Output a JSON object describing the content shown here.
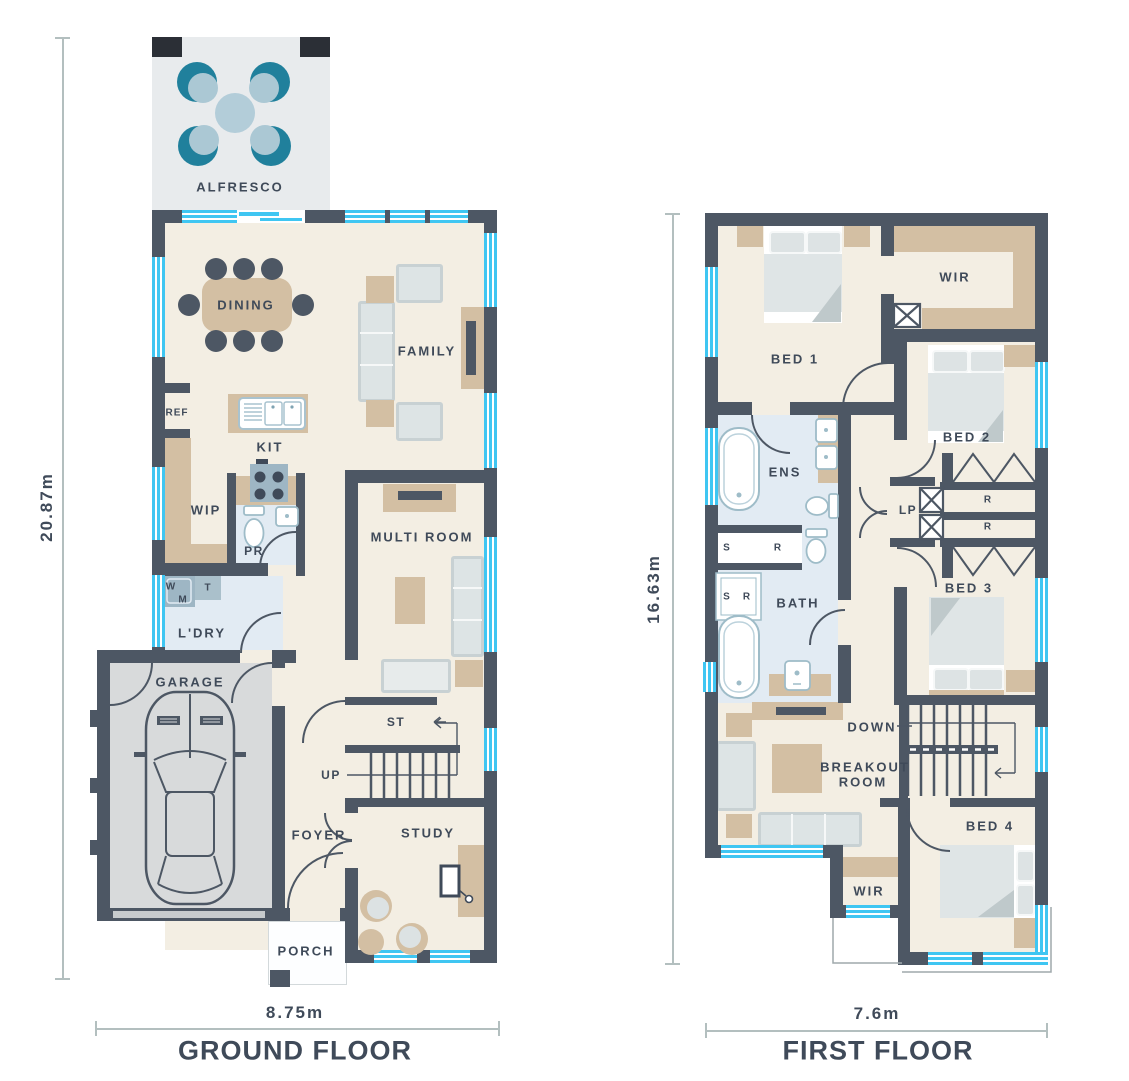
{
  "document": {
    "type": "architectural floor plan, two storeys"
  },
  "palette": {
    "wall": "#4d5764",
    "window": "#3fc6f2",
    "floor": "#f3eee3",
    "wet_area": "#e2ebf3",
    "furniture_tan": "#d3bfa3",
    "garage_floor": "#d8dadb",
    "alfresco_floor": "#e8ebed",
    "sofa_gray": "#dde4e5",
    "outdoor_teal": "#20809c",
    "outdoor_blue": "#b3cdd9",
    "text": "#3f4a59",
    "dim_line": "#b3bfbf"
  },
  "ground_floor": {
    "title": "GROUND FLOOR",
    "width_dim": "8.75m",
    "height_dim": "20.87m",
    "labels": {
      "alfresco": "ALFRESCO",
      "dining": "DINING",
      "family": "FAMILY",
      "ref": "REF",
      "kit": "KIT",
      "wip": "WIP",
      "pr": "PR",
      "multi_room": "MULTI ROOM",
      "w": "W",
      "m": "M",
      "t": "T",
      "ldry": "L'DRY",
      "garage": "GARAGE",
      "st": "ST",
      "up": "UP",
      "foyer": "FOYER",
      "study": "STUDY",
      "porch": "PORCH"
    }
  },
  "first_floor": {
    "title": "FIRST FLOOR",
    "width_dim": "7.6m",
    "height_dim": "16.63m",
    "labels": {
      "bed1": "BED 1",
      "wir": "WIR",
      "bed2": "BED 2",
      "ens": "ENS",
      "lp": "LP",
      "r": "R",
      "s": "S",
      "bath": "BATH",
      "bed3": "BED 3",
      "down": "DOWN",
      "breakout_line1": "BREAKOUT",
      "breakout_line2": "ROOM",
      "bed4": "BED 4"
    }
  }
}
